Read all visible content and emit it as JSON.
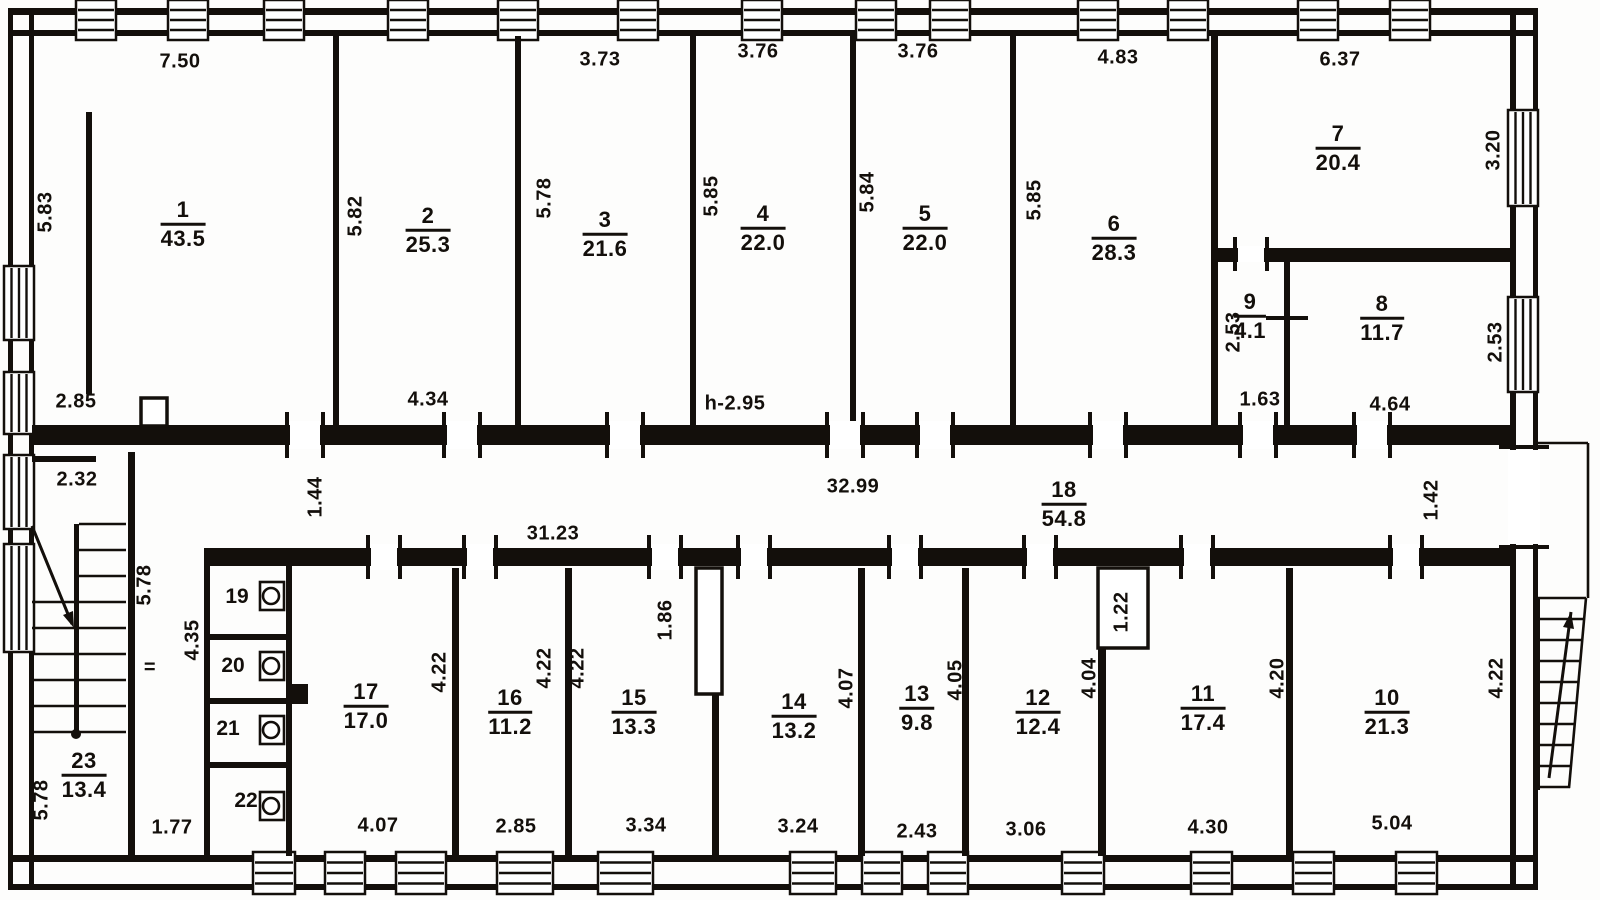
{
  "canvas": {
    "w": 1600,
    "h": 900,
    "paper": "#fdfdfc",
    "ink": "#17130f"
  },
  "rooms": [
    {
      "num": "1",
      "area": "43.5",
      "x": 183,
      "y": 224
    },
    {
      "num": "2",
      "area": "25.3",
      "x": 428,
      "y": 230
    },
    {
      "num": "3",
      "area": "21.6",
      "x": 605,
      "y": 234
    },
    {
      "num": "4",
      "area": "22.0",
      "x": 763,
      "y": 228
    },
    {
      "num": "5",
      "area": "22.0",
      "x": 925,
      "y": 228
    },
    {
      "num": "6",
      "area": "28.3",
      "x": 1114,
      "y": 238
    },
    {
      "num": "7",
      "area": "20.4",
      "x": 1338,
      "y": 148
    },
    {
      "num": "8",
      "area": "11.7",
      "x": 1382,
      "y": 318
    },
    {
      "num": "9",
      "area": "4.1",
      "x": 1250,
      "y": 316
    },
    {
      "num": "10",
      "area": "21.3",
      "x": 1387,
      "y": 712
    },
    {
      "num": "11",
      "area": "17.4",
      "x": 1203,
      "y": 708
    },
    {
      "num": "12",
      "area": "12.4",
      "x": 1038,
      "y": 712
    },
    {
      "num": "13",
      "area": "9.8",
      "x": 917,
      "y": 708
    },
    {
      "num": "14",
      "area": "13.2",
      "x": 794,
      "y": 716
    },
    {
      "num": "15",
      "area": "13.3",
      "x": 634,
      "y": 712
    },
    {
      "num": "16",
      "area": "11.2",
      "x": 510,
      "y": 712
    },
    {
      "num": "17",
      "area": "17.0",
      "x": 366,
      "y": 706
    },
    {
      "num": "18",
      "area": "54.8",
      "x": 1064,
      "y": 504
    },
    {
      "num": "23",
      "area": "13.4",
      "x": 84,
      "y": 775
    }
  ],
  "stalls": [
    {
      "num": "19",
      "x": 237,
      "y": 597
    },
    {
      "num": "20",
      "x": 233,
      "y": 666
    },
    {
      "num": "21",
      "x": 228,
      "y": 729
    },
    {
      "num": "22",
      "x": 246,
      "y": 801
    }
  ],
  "dims": [
    {
      "t": "7.50",
      "x": 180,
      "y": 62
    },
    {
      "t": "3.73",
      "x": 600,
      "y": 60
    },
    {
      "t": "3.76",
      "x": 758,
      "y": 52
    },
    {
      "t": "3.76",
      "x": 918,
      "y": 52
    },
    {
      "t": "4.83",
      "x": 1118,
      "y": 58
    },
    {
      "t": "6.37",
      "x": 1340,
      "y": 60
    },
    {
      "t": "5.83",
      "x": 46,
      "y": 212,
      "v": 1
    },
    {
      "t": "5.82",
      "x": 356,
      "y": 216,
      "v": 1
    },
    {
      "t": "5.78",
      "x": 545,
      "y": 198,
      "v": 1
    },
    {
      "t": "5.85",
      "x": 712,
      "y": 196,
      "v": 1
    },
    {
      "t": "5.84",
      "x": 868,
      "y": 192,
      "v": 1
    },
    {
      "t": "5.85",
      "x": 1035,
      "y": 200,
      "v": 1
    },
    {
      "t": "3.20",
      "x": 1494,
      "y": 150,
      "v": 1
    },
    {
      "t": "2.85",
      "x": 76,
      "y": 402
    },
    {
      "t": "4.34",
      "x": 428,
      "y": 400
    },
    {
      "t": "h-2.95",
      "x": 735,
      "y": 404
    },
    {
      "t": "2.53",
      "x": 1234,
      "y": 332,
      "v": 1
    },
    {
      "t": "1.63",
      "x": 1260,
      "y": 400
    },
    {
      "t": "4.64",
      "x": 1390,
      "y": 405
    },
    {
      "t": "2.53",
      "x": 1496,
      "y": 342,
      "v": 1
    },
    {
      "t": "2.32",
      "x": 77,
      "y": 480
    },
    {
      "t": "1.44",
      "x": 316,
      "y": 497,
      "v": 1
    },
    {
      "t": "32.99",
      "x": 853,
      "y": 487
    },
    {
      "t": "31.23",
      "x": 553,
      "y": 534
    },
    {
      "t": "1.42",
      "x": 1432,
      "y": 500,
      "v": 1
    },
    {
      "t": "5.78",
      "x": 145,
      "y": 585,
      "v": 1
    },
    {
      "t": "4.35",
      "x": 193,
      "y": 640,
      "v": 1
    },
    {
      "t": "=",
      "x": 150,
      "y": 668
    },
    {
      "t": "5.78",
      "x": 42,
      "y": 800,
      "v": 1
    },
    {
      "t": "1.77",
      "x": 172,
      "y": 828
    },
    {
      "t": "4.22",
      "x": 440,
      "y": 672,
      "v": 1
    },
    {
      "t": "4.22",
      "x": 545,
      "y": 668,
      "v": 1
    },
    {
      "t": "4.22",
      "x": 578,
      "y": 668,
      "v": 1
    },
    {
      "t": "1.86",
      "x": 666,
      "y": 620,
      "v": 1
    },
    {
      "t": "4.07",
      "x": 847,
      "y": 688,
      "v": 1
    },
    {
      "t": "4.05",
      "x": 956,
      "y": 680,
      "v": 1
    },
    {
      "t": "4.04",
      "x": 1090,
      "y": 678,
      "v": 1
    },
    {
      "t": "1.22",
      "x": 1122,
      "y": 612,
      "v": 1
    },
    {
      "t": "4.20",
      "x": 1278,
      "y": 678,
      "v": 1
    },
    {
      "t": "4.22",
      "x": 1497,
      "y": 678,
      "v": 1
    },
    {
      "t": "4.07",
      "x": 378,
      "y": 826
    },
    {
      "t": "2.85",
      "x": 516,
      "y": 827
    },
    {
      "t": "3.34",
      "x": 646,
      "y": 826
    },
    {
      "t": "3.24",
      "x": 798,
      "y": 827
    },
    {
      "t": "2.43",
      "x": 917,
      "y": 832
    },
    {
      "t": "3.06",
      "x": 1026,
      "y": 830
    },
    {
      "t": "4.30",
      "x": 1208,
      "y": 828
    },
    {
      "t": "5.04",
      "x": 1392,
      "y": 824
    }
  ],
  "geometry": {
    "line_walls": [
      [
        8,
        8,
        1530,
        7
      ],
      [
        8,
        30,
        1530,
        6
      ],
      [
        8,
        855,
        1530,
        7
      ],
      [
        8,
        884,
        1530,
        6
      ],
      [
        8,
        8,
        5,
        882
      ],
      [
        29,
        8,
        5,
        882
      ],
      [
        1533,
        8,
        5,
        882
      ],
      [
        1510,
        8,
        6,
        882
      ]
    ],
    "solid_walls": [
      [
        333,
        36,
        6,
        389
      ],
      [
        515,
        36,
        6,
        389
      ],
      [
        690,
        36,
        6,
        389
      ],
      [
        850,
        36,
        6,
        389
      ],
      [
        1010,
        36,
        6,
        389
      ],
      [
        1211,
        36,
        7,
        389
      ],
      [
        1211,
        248,
        299,
        14
      ],
      [
        1284,
        262,
        6,
        163
      ],
      [
        86,
        112,
        6,
        282
      ],
      [
        32,
        425,
        1478,
        20
      ],
      [
        204,
        548,
        1306,
        18
      ],
      [
        32,
        456,
        64,
        6
      ],
      [
        128,
        452,
        7,
        404
      ],
      [
        204,
        552,
        6,
        304
      ],
      [
        286,
        552,
        6,
        304
      ],
      [
        204,
        552,
        88,
        6
      ],
      [
        206,
        634,
        80,
        6
      ],
      [
        206,
        698,
        80,
        6
      ],
      [
        206,
        762,
        80,
        6
      ],
      [
        288,
        684,
        20,
        20
      ],
      [
        452,
        568,
        7,
        288
      ],
      [
        565,
        568,
        7,
        288
      ],
      [
        712,
        692,
        7,
        164
      ],
      [
        858,
        568,
        7,
        288
      ],
      [
        962,
        568,
        7,
        288
      ],
      [
        1098,
        646,
        8,
        210
      ],
      [
        1286,
        568,
        7,
        288
      ],
      [
        74,
        524,
        5,
        212
      ],
      [
        1536,
        598,
        4,
        192
      ]
    ],
    "windows": [
      [
        76,
        0,
        40,
        40,
        "h"
      ],
      [
        168,
        0,
        40,
        40,
        "h"
      ],
      [
        264,
        0,
        40,
        40,
        "h"
      ],
      [
        388,
        0,
        40,
        40,
        "h"
      ],
      [
        498,
        0,
        40,
        40,
        "h"
      ],
      [
        618,
        0,
        40,
        40,
        "h"
      ],
      [
        742,
        0,
        40,
        40,
        "h"
      ],
      [
        856,
        0,
        40,
        40,
        "h"
      ],
      [
        930,
        0,
        40,
        40,
        "h"
      ],
      [
        1078,
        0,
        40,
        40,
        "h"
      ],
      [
        1168,
        0,
        40,
        40,
        "h"
      ],
      [
        1298,
        0,
        40,
        40,
        "h"
      ],
      [
        1390,
        0,
        40,
        40,
        "h"
      ],
      [
        253,
        852,
        42,
        42,
        "h"
      ],
      [
        325,
        852,
        40,
        42,
        "h"
      ],
      [
        396,
        852,
        50,
        42,
        "h"
      ],
      [
        497,
        852,
        56,
        42,
        "h"
      ],
      [
        598,
        852,
        55,
        42,
        "h"
      ],
      [
        790,
        852,
        46,
        42,
        "h"
      ],
      [
        862,
        852,
        40,
        42,
        "h"
      ],
      [
        928,
        852,
        40,
        42,
        "h"
      ],
      [
        1062,
        852,
        42,
        42,
        "h"
      ],
      [
        1191,
        852,
        41,
        42,
        "h"
      ],
      [
        1293,
        852,
        41,
        42,
        "h"
      ],
      [
        1396,
        852,
        41,
        42,
        "h"
      ],
      [
        4,
        266,
        30,
        74,
        "v"
      ],
      [
        4,
        372,
        30,
        62,
        "v"
      ],
      [
        4,
        455,
        30,
        74,
        "v"
      ],
      [
        4,
        544,
        30,
        108,
        "v"
      ],
      [
        1508,
        110,
        30,
        96,
        "v"
      ],
      [
        1508,
        297,
        30,
        95,
        "v"
      ]
    ],
    "outline_rects": [
      [
        141,
        398,
        26,
        28
      ],
      [
        696,
        568,
        26,
        126
      ],
      [
        1098,
        568,
        50,
        80
      ]
    ],
    "door_gaps": [
      [
        290,
        421,
        30,
        28,
        "v"
      ],
      [
        447,
        421,
        30,
        28,
        "v"
      ],
      [
        610,
        421,
        30,
        28,
        "v"
      ],
      [
        830,
        421,
        30,
        28,
        "v"
      ],
      [
        920,
        421,
        30,
        28,
        "v"
      ],
      [
        1093,
        421,
        30,
        28,
        "v"
      ],
      [
        1243,
        421,
        30,
        28,
        "v"
      ],
      [
        1357,
        421,
        30,
        28,
        "v"
      ],
      [
        371,
        544,
        26,
        26,
        "v"
      ],
      [
        467,
        544,
        26,
        26,
        "v"
      ],
      [
        652,
        544,
        26,
        26,
        "v"
      ],
      [
        741,
        544,
        26,
        26,
        "v"
      ],
      [
        892,
        544,
        26,
        26,
        "v"
      ],
      [
        1027,
        544,
        26,
        26,
        "v"
      ],
      [
        1184,
        544,
        26,
        26,
        "v"
      ],
      [
        1393,
        544,
        26,
        26,
        "v"
      ],
      [
        1238,
        246,
        26,
        16,
        "v"
      ],
      [
        1508,
        450,
        32,
        94,
        "h"
      ]
    ],
    "ticks": [
      [
        1266,
        316,
        42,
        4
      ]
    ],
    "lines": [
      [
        79,
        524,
        126,
        524
      ],
      [
        79,
        550,
        126,
        550
      ],
      [
        79,
        576,
        126,
        576
      ],
      [
        79,
        602,
        126,
        602
      ],
      [
        79,
        628,
        126,
        628
      ],
      [
        79,
        654,
        126,
        654
      ],
      [
        79,
        680,
        126,
        680
      ],
      [
        79,
        706,
        126,
        706
      ],
      [
        79,
        732,
        126,
        732
      ],
      [
        32,
        602,
        74,
        602
      ],
      [
        32,
        628,
        74,
        628
      ],
      [
        32,
        654,
        74,
        654
      ],
      [
        32,
        680,
        74,
        680
      ],
      [
        32,
        706,
        74,
        706
      ],
      [
        32,
        732,
        74,
        732
      ],
      [
        32,
        526,
        72,
        624
      ],
      [
        1538,
        443,
        1588,
        443
      ],
      [
        1588,
        443,
        1588,
        598
      ],
      [
        1538,
        598,
        1586,
        598
      ],
      [
        1538,
        619,
        1584,
        619
      ],
      [
        1538,
        640,
        1582,
        640
      ],
      [
        1538,
        661,
        1581,
        661
      ],
      [
        1538,
        682,
        1579,
        682
      ],
      [
        1538,
        703,
        1577,
        703
      ],
      [
        1538,
        724,
        1575,
        724
      ],
      [
        1538,
        745,
        1574,
        745
      ],
      [
        1538,
        766,
        1572,
        766
      ],
      [
        1538,
        787,
        1570,
        787
      ],
      [
        1586,
        598,
        1569,
        788
      ]
    ],
    "arrows": [
      {
        "l": [
          32,
          526,
          72,
          624
        ],
        "h": [
          74,
          628,
          63,
          615,
          73,
          611
        ]
      },
      {
        "l": [
          1549,
          778,
          1571,
          612
        ],
        "h": [
          1571,
          612,
          1574,
          629,
          1563,
          627
        ]
      }
    ],
    "circles": [
      [
        76,
        734,
        5
      ]
    ],
    "fixtures": [
      {
        "x": 260,
        "y": 582
      },
      {
        "x": 260,
        "y": 652
      },
      {
        "x": 260,
        "y": 716
      },
      {
        "x": 260,
        "y": 792
      }
    ]
  }
}
